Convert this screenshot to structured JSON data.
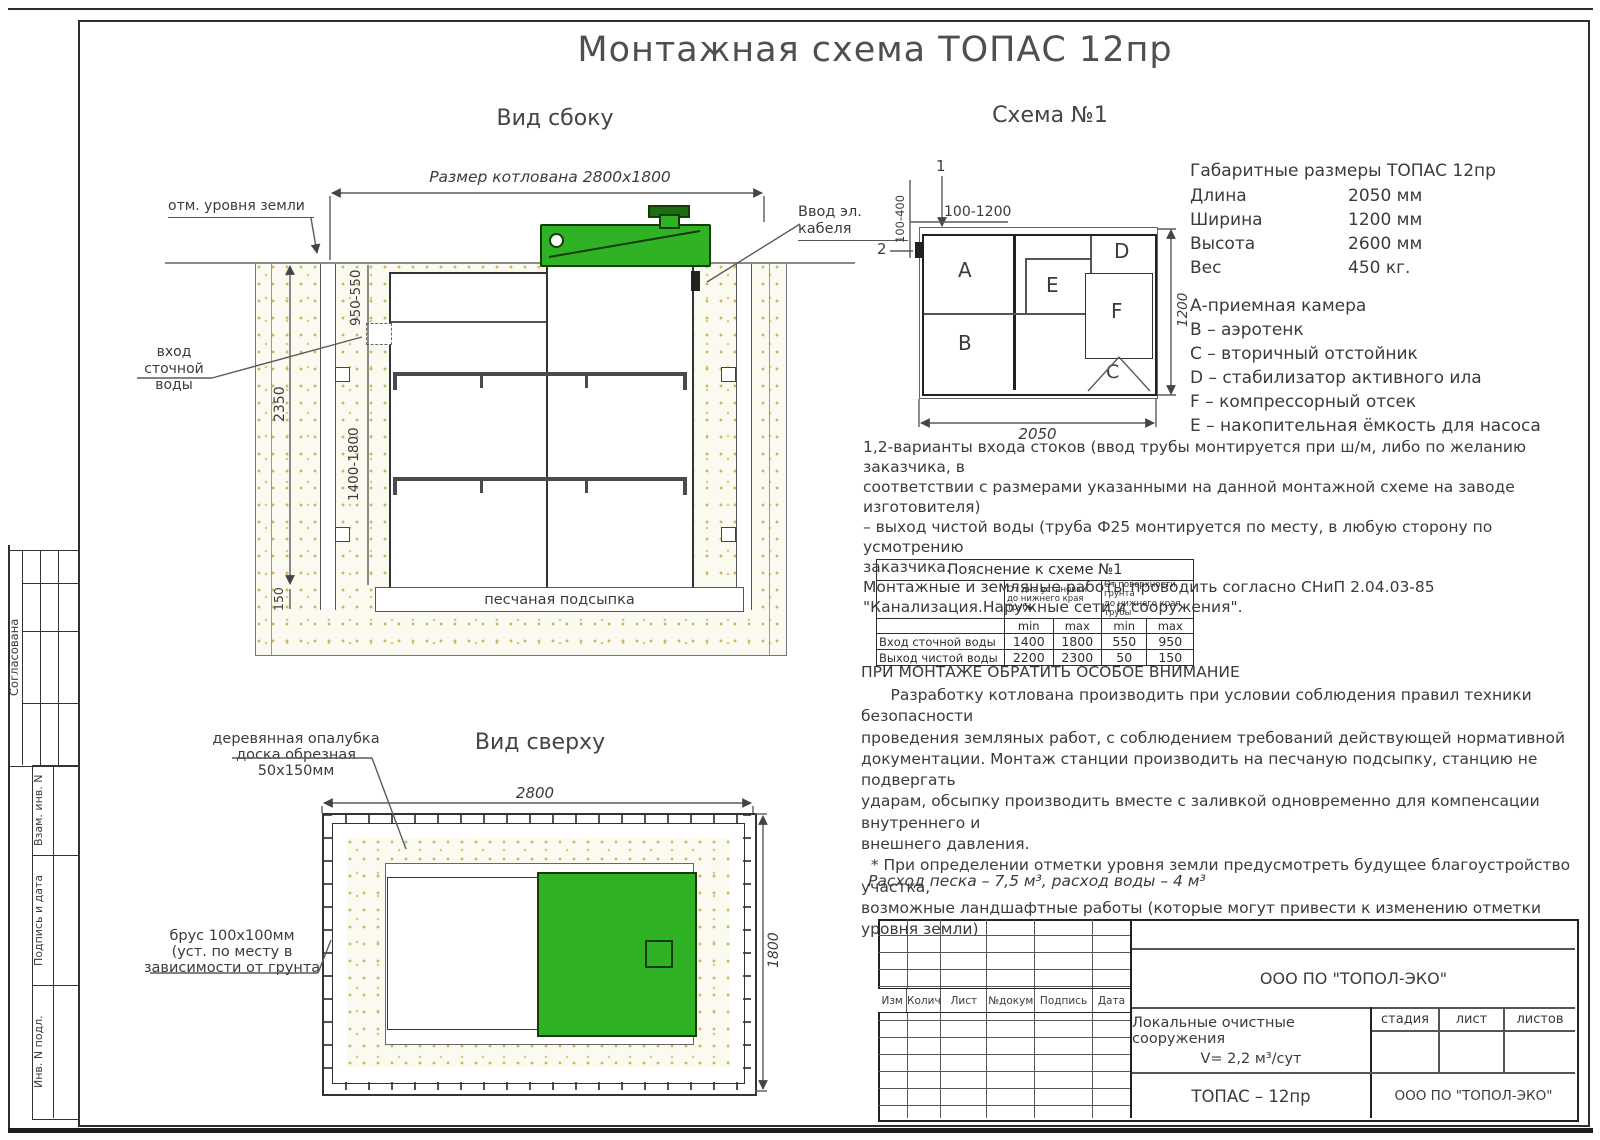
{
  "page": {
    "title": "Монтажная схема ТОПАС 12пр"
  },
  "side_view": {
    "title": "Вид сбоку",
    "pit_dim": "Размер котлована 2800х1800",
    "ground_label": "отм. уровня земли",
    "cable_label": "Ввод эл. кабеля",
    "inlet_label": "вход\nсточной\nводы",
    "dim_depth": "2350",
    "dim_top_range": "950-550",
    "dim_mid_range": "1400-1800",
    "dim_bottom": "150",
    "sand_label": "песчаная подсыпка"
  },
  "schema": {
    "title": "Схема №1",
    "marker_1": "1",
    "marker_2": "2",
    "dim_top": "100-1200",
    "dim_left": "100-400",
    "dim_width": "2050",
    "dim_height": "1200",
    "comp_a": "A",
    "comp_b": "B",
    "comp_c": "C",
    "comp_d": "D",
    "comp_e": "E",
    "comp_f": "F"
  },
  "overall": {
    "title": "Габаритные размеры ТОПАС 12пр",
    "rows": [
      {
        "label": "Длина",
        "value": "2050 мм"
      },
      {
        "label": "Ширина",
        "value": "1200 мм"
      },
      {
        "label": "Высота",
        "value": "2600 мм"
      },
      {
        "label": "Вес",
        "value": "450 кг."
      }
    ]
  },
  "legend": {
    "items": [
      "А-приемная камера",
      "В – аэротенк",
      "С – вторичный отстойник",
      "D – стабилизатор активного  ила",
      "F  – компрессорный отсек",
      "Е – накопительная ёмкость для насоса"
    ]
  },
  "notes": {
    "variants": "1,2-варианты входа  стоков (ввод трубы монтируется при ш/м, либо по желанию заказчика, в\nсоответствии с размерами указанными на данной монтажной схеме на заводе изготовителя)\n– выход чистой воды (труба Ф25 монтируется по месту, в любую сторону по усмотрению\nзаказчика.\nМонтажные и земляные работы проводить согласно СНиП 2.04.03-85\n\"Канализация.Наружные сети и сооружения\".",
    "attention_title": "ПРИ МОНТАЖЕ ОБРАТИТЬ ОСОБОЕ ВНИМАНИЕ",
    "attention_body": "      Разработку котлована производить при условии соблюдения правил техники безопасности\nпроведения земляных работ, с соблюдением требований действующей нормативной\nдокументации. Монтаж станции производить на песчаную подсыпку, станцию не подвергать\nударам, обсыпку производить вместе с заливкой одновременно для компенсации внутреннего и\nвнешнего давления.\n  * При определении отметки уровня земли предусмотреть будущее благоустройство участка,\nвозможные ландшафтные работы (которые могут привести к изменению отметки уровня земли)",
    "sand_note": "Расход песка – 7,5 м³, расход воды – 4 м³"
  },
  "pipe_table": {
    "title": "Пояснение к схеме №1",
    "group1": "От дна установки\nдо нижнего края трубы",
    "group2": "От поверхности грунта\nдо нижнего края трубы",
    "min1": "min",
    "max1": "max",
    "min2": "min",
    "max2": "max",
    "rows": [
      {
        "label": "Вход сточной воды",
        "v0": "1400",
        "v1": "1800",
        "v2": "550",
        "v3": "950"
      },
      {
        "label": "Выход чистой воды",
        "v0": "2200",
        "v1": "2300",
        "v2": "50",
        "v3": "150"
      }
    ]
  },
  "top_view": {
    "title": "Вид сверху",
    "formwork_label": "деревянная опалубка\nдоска обрезная\n50х150мм",
    "beam_label": "брус 100х100мм\n(уст. по месту в\nзависимости от грунта",
    "dim_width": "2800",
    "dim_height": "1800"
  },
  "title_block": {
    "cols": [
      "Изм",
      "Колич",
      "Лист",
      "№докум",
      "Подпись",
      "Дата"
    ],
    "company": "ООО ПО \"ТОПОЛ-ЭКО\"",
    "project_line1": "Локальные очистные сооружения",
    "project_line2": "V= 2,2 м³/сут",
    "stage": "стадия",
    "sheet": "лист",
    "sheets": "листов",
    "model": "ТОПАС – 12пр",
    "company2": "ООО ПО \"ТОПОЛ-ЭКО\""
  },
  "stamp_column": {
    "agreed": "Согласована",
    "label1": "Взам. инв. N",
    "label2": "Подпись и дата",
    "label3": "Инв. N подл."
  },
  "colors": {
    "green": "#2fb325",
    "green_dark": "#143c06",
    "line": "#4a4a4a",
    "sand_dot": "#c9b35b"
  }
}
